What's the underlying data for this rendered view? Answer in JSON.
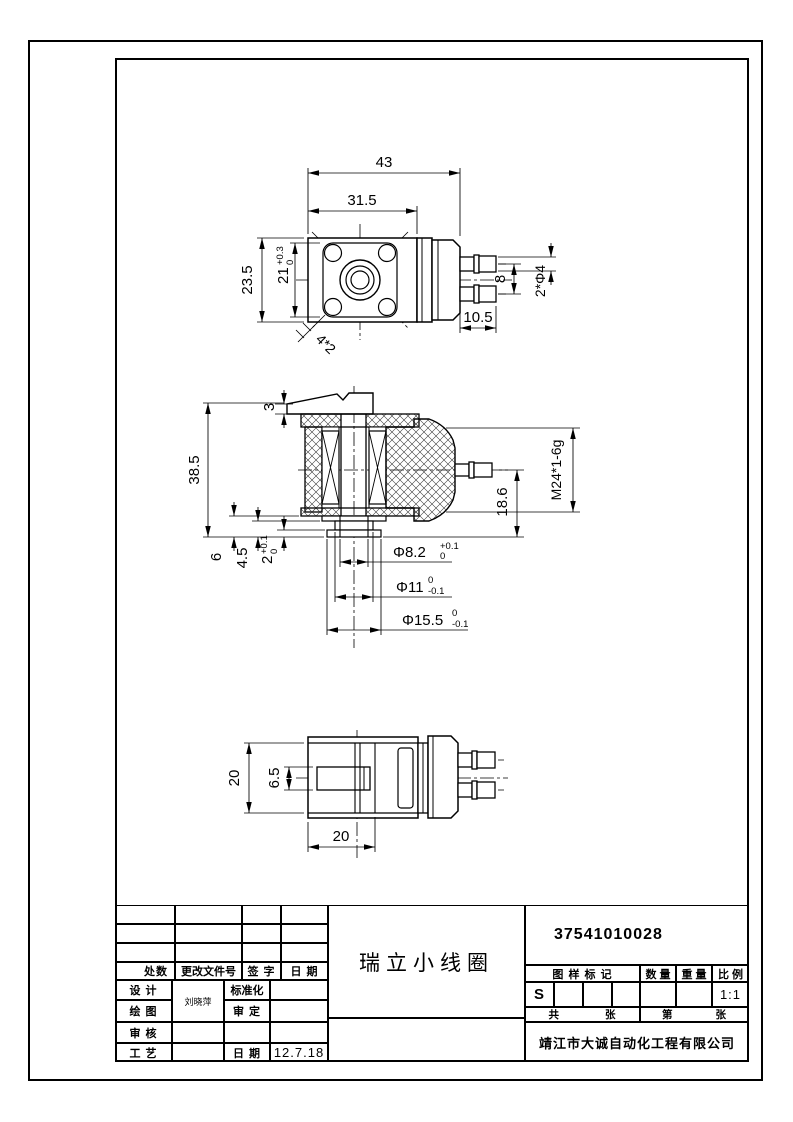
{
  "views": {
    "top": {
      "width_overall": "43",
      "width_flange": "31.5",
      "height_flange": "23.5",
      "square": "21",
      "square_tol_upper": "+0.3",
      "square_tol_lower": "0",
      "pin_pitch": "8",
      "pin_length": "10.5",
      "pin_dia": "2*Φ4",
      "corner_holes": "4*2"
    },
    "section": {
      "overall_height": "38.5",
      "top_plate": "3",
      "step_6": "6",
      "step_4_5": "4.5",
      "step_2": "2",
      "step_2_tol_upper": "+0.1",
      "step_2_tol_lower": "0",
      "pin_height": "18.6",
      "thread": "M24*1-6g",
      "bore_dia": "Φ8.2",
      "bore_tol_upper": "+0.1",
      "bore_tol_lower": "0",
      "mid_dia": "Φ11",
      "mid_tol_upper": "0",
      "mid_tol_lower": "-0.1",
      "flange_dia": "Φ15.5",
      "flange_tol_upper": "0",
      "flange_tol_lower": "-0.1"
    },
    "bottom": {
      "height": "20",
      "slot": "6.5",
      "width": "20"
    }
  },
  "title_block": {
    "part_number": "37541010028",
    "part_name": "瑞立小线圈",
    "company": "靖江市大诚自动化工程有限公司",
    "left": {
      "changes_header": "处数",
      "doc_no_header": "更改文件号",
      "signature_header": "签 字",
      "date_header": "日 期",
      "design_label": "设 计",
      "draft_label": "绘 图",
      "check_label": "审 核",
      "process_label": "工 艺",
      "standardize_label": "标准化",
      "approve_label": "审 定",
      "date_label": "日 期",
      "designer_name": "刘晓萍",
      "date_value": "12.7.18"
    },
    "right": {
      "mark_header": "图 样 标 记",
      "qty_header": "数 量",
      "weight_header": "重 量",
      "scale_header": "比 例",
      "mark_value": "S",
      "scale_value": "1:1",
      "sheet_total_label": "共",
      "sheet_word": "张",
      "sheet_no_label": "第"
    }
  }
}
